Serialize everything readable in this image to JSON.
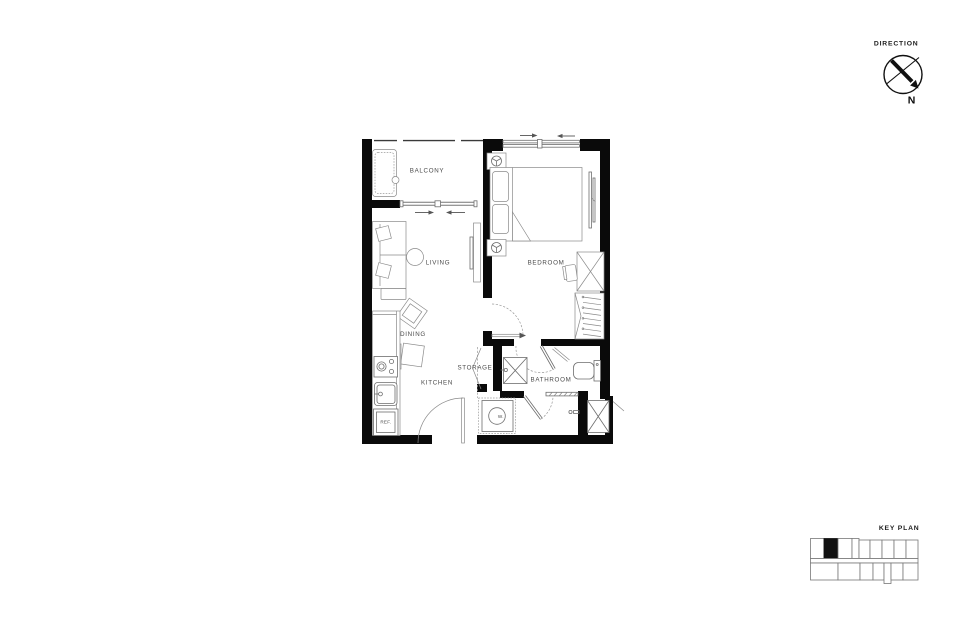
{
  "direction": {
    "label": "DIRECTION",
    "north": "N"
  },
  "key_plan": {
    "label": "KEY PLAN"
  },
  "floor_plan": {
    "rooms": {
      "balcony": "BALCONY",
      "living": "LIVING",
      "dining": "DINING",
      "kitchen": "KITCHEN",
      "storage": "STORAGE",
      "bathroom": "BATHROOM",
      "bedroom": "BEDROOM"
    },
    "appliances": {
      "refrigerator": "REF.",
      "washer": "W."
    }
  },
  "colors": {
    "background": "#ffffff",
    "wall": "#0a0a0a",
    "furniture_line": "#8a8a8a",
    "fixture_line": "#6e6e6e",
    "label": "#4a4a4a",
    "highlight_unit": "#111111"
  }
}
